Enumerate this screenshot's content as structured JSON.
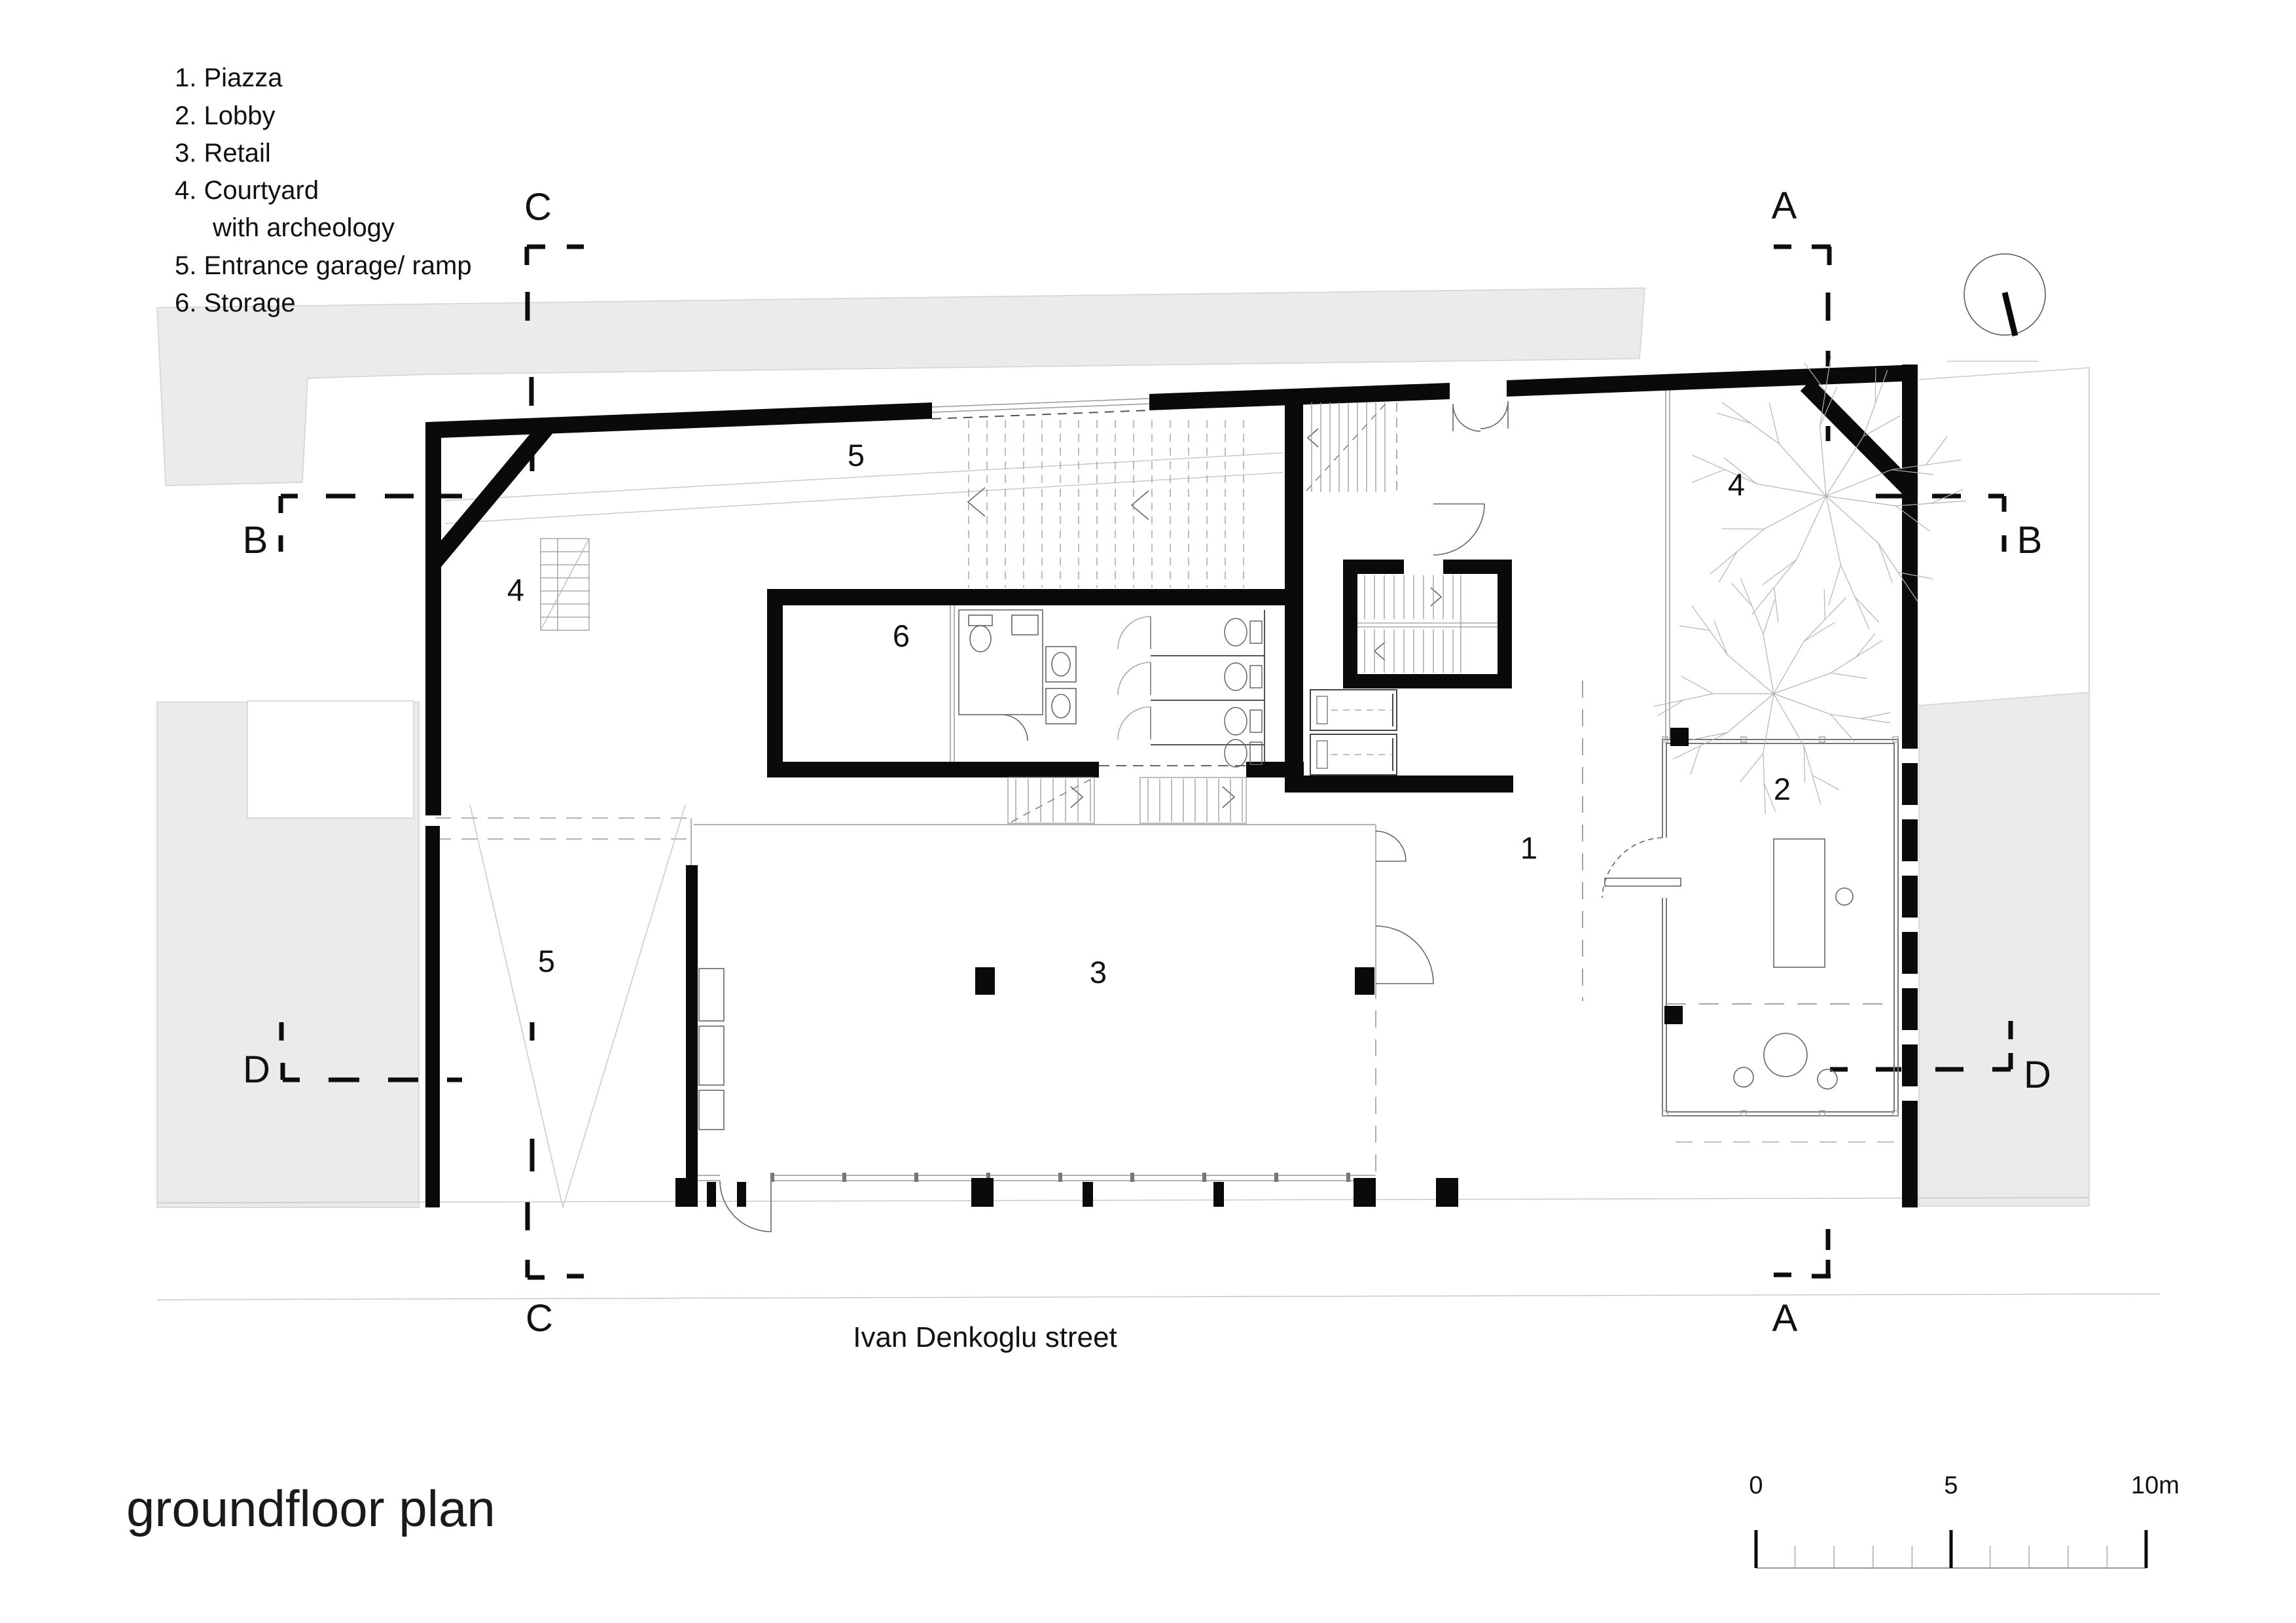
{
  "title": "groundfloor plan",
  "street_label": "Ivan Denkoglu street",
  "legend": {
    "items": [
      "1.  Piazza",
      "2.  Lobby",
      "3.  Retail",
      "4.  Courtyard",
      "with archeology",
      "5. Entrance garage/ ramp",
      "6. Storage"
    ]
  },
  "room_labels": {
    "piazza": "1",
    "lobby": "2",
    "retail": "3",
    "courtyard_left": "4",
    "courtyard_right": "4",
    "ramp_top": "5",
    "ramp_bottom": "5",
    "storage": "6"
  },
  "section_markers": {
    "a_top": "A",
    "a_bottom": "A",
    "b_left": "B",
    "b_right": "B",
    "c_top": "C",
    "c_bottom": "C",
    "d_left": "D",
    "d_right": "D"
  },
  "scale_bar": {
    "labels": [
      "0",
      "5",
      "10m"
    ]
  },
  "colors": {
    "wall": "#0a0a0a",
    "neighbor_fill": "#ebebeb",
    "thin_line": "#999999",
    "section_line": "#0d0d0d"
  }
}
